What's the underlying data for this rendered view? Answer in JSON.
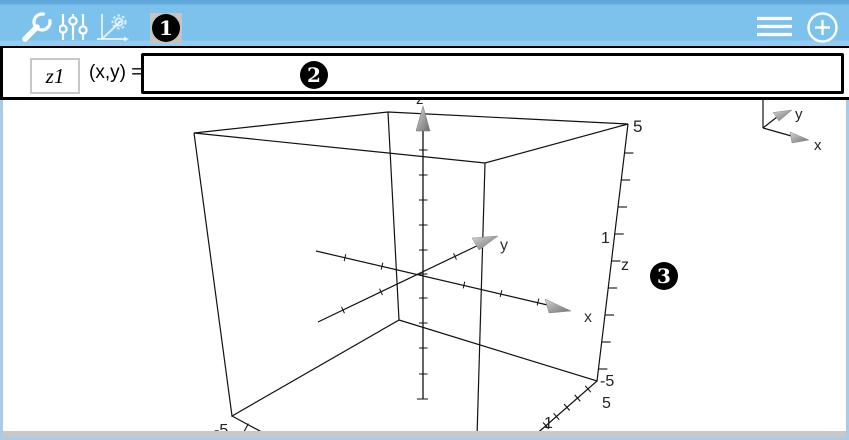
{
  "toolbar": {
    "icons": {
      "tools": "wrench-icon",
      "settings": "sliders-icon",
      "graph_setup": "graph-gear-icon",
      "menu": "hamburger-menu-icon",
      "add": "plus-circle-icon"
    },
    "bg_top": "#61a9db",
    "bg_main": "#7cc2ed",
    "bg_bottom": "#92ccf1"
  },
  "entry_line": {
    "function_name": "z1",
    "signature": "(x,y) = ",
    "expression_value": ""
  },
  "callouts": {
    "one": "1",
    "two": "2",
    "three": "3"
  },
  "graph3d": {
    "axis_range": [
      -5,
      5
    ],
    "z_top_label": "z",
    "right_edge": {
      "max": "5",
      "unit": "1",
      "axis": "z",
      "min": "-5"
    },
    "bottom_right_edge": {
      "max": "5",
      "unit": "1"
    },
    "bottom_left_edge": {
      "min": "-5"
    },
    "x_axis_label": "x",
    "y_axis_label": "y",
    "mini_axes": {
      "x": "x",
      "y": "y"
    }
  },
  "colors": {
    "frame_blue": "#a9cce6",
    "bottom_bar_gray": "#c8c8c8",
    "wire_black": "#111111",
    "arrow_gray": "#8a8a8a",
    "callout_bg": "#000000",
    "callout_fg": "#ffffff"
  }
}
